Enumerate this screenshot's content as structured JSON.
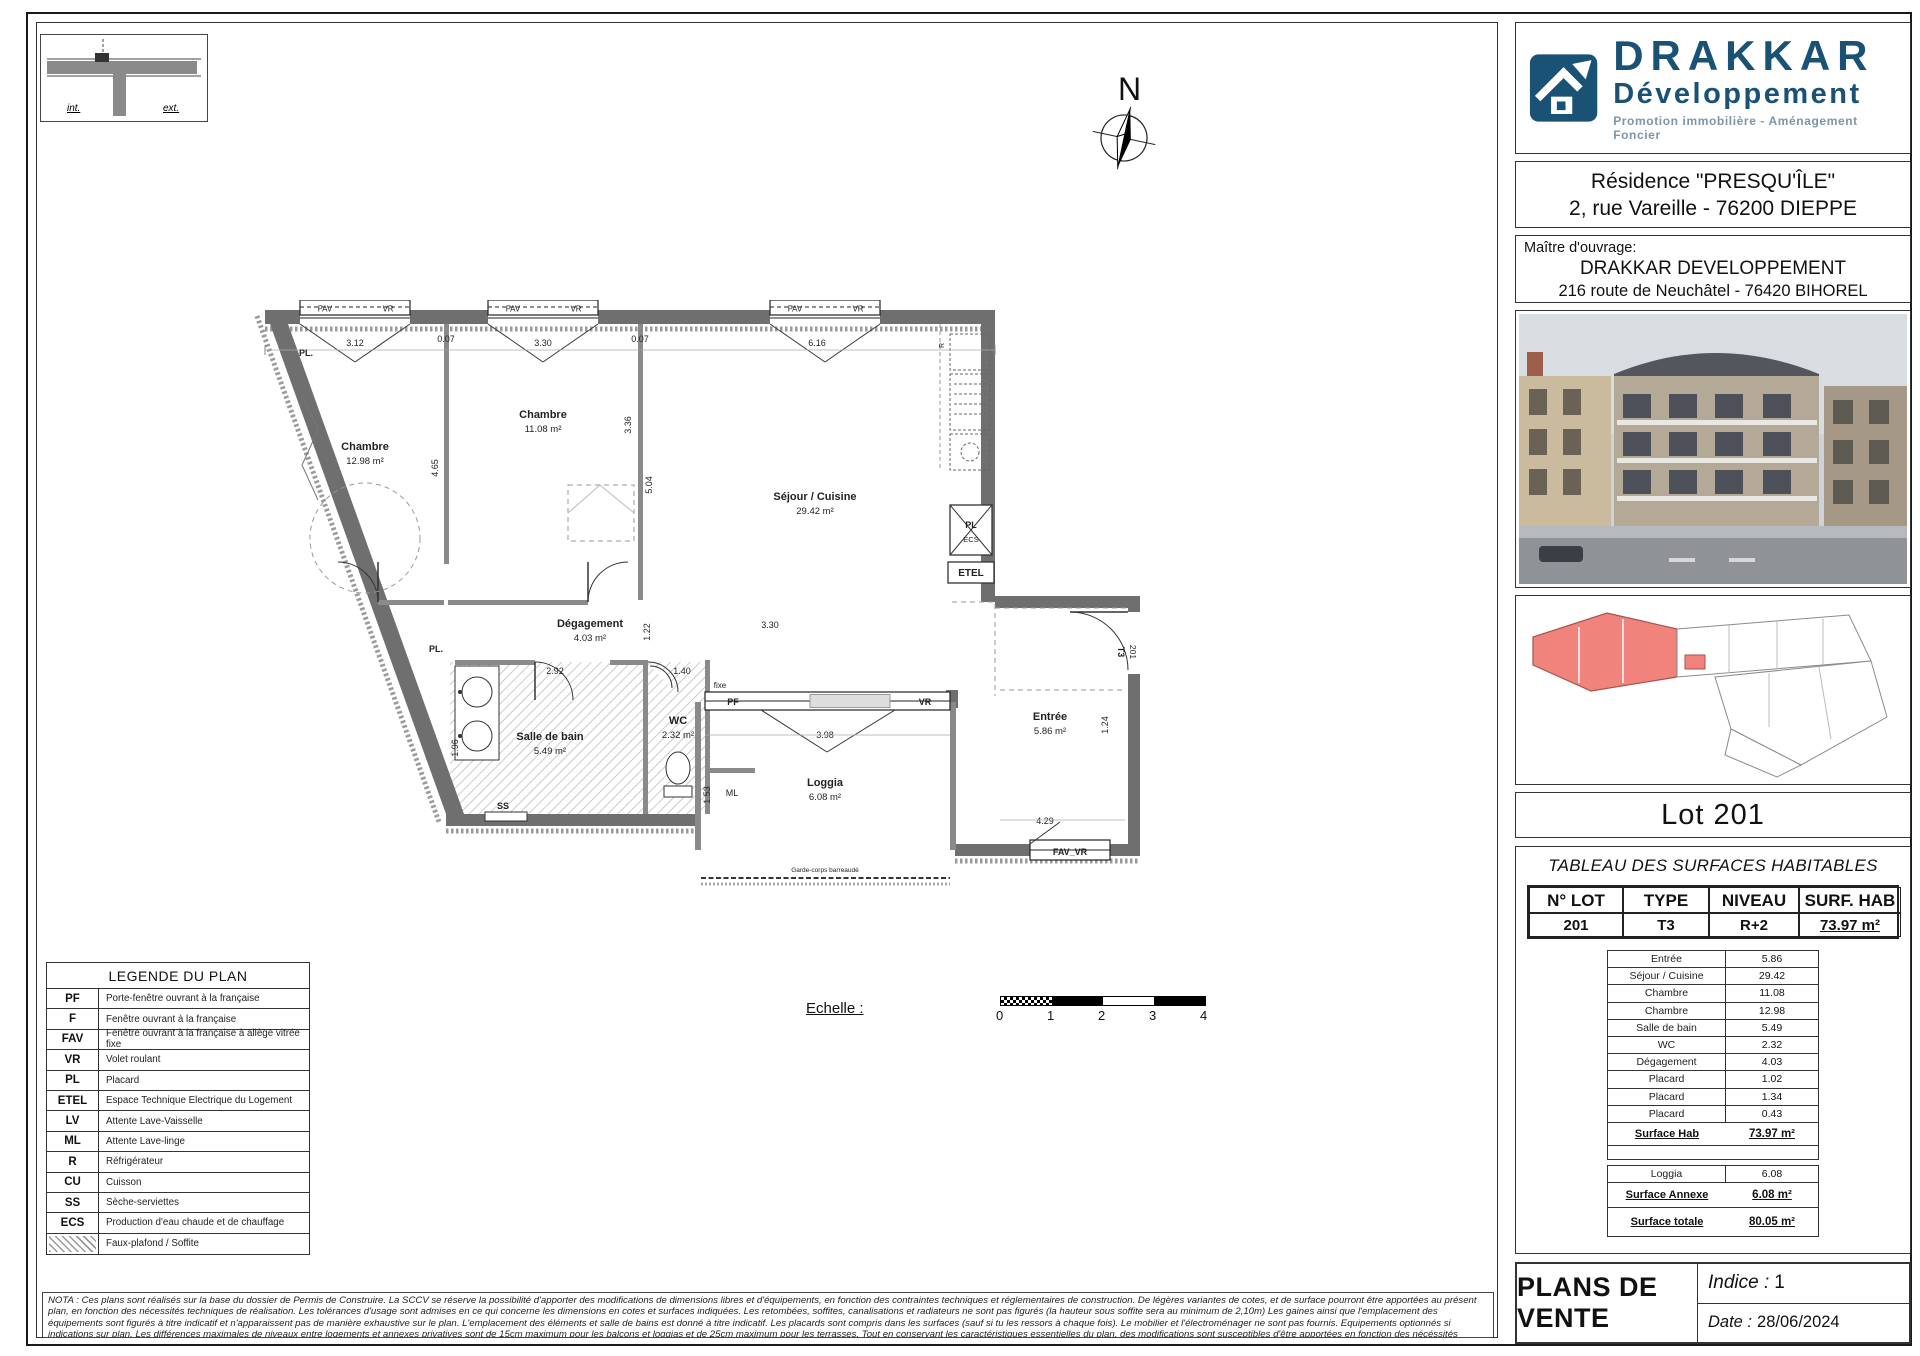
{
  "header": {
    "logo": {
      "name": "DRAKKAR",
      "subname": "Développement",
      "tagline": "Promotion immobilière - Aménagement Foncier",
      "brand_color": "#1a5276"
    },
    "residence": {
      "line1": "Résidence \"PRESQU'ÎLE\"",
      "line2": "2, rue Vareille - 76200 DIEPPE"
    },
    "maitre": {
      "label": "Maître d'ouvrage:",
      "line1": "DRAKKAR DEVELOPPEMENT",
      "line2": "216 route de Neuchâtel - 76420 BIHOREL"
    }
  },
  "lot": {
    "title": "Lot 201"
  },
  "surfaces": {
    "title": "TABLEAU DES SURFACES HABITABLES",
    "headers": [
      "N° LOT",
      "TYPE",
      "NIVEAU",
      "SURF. HAB"
    ],
    "main_row": {
      "lot": "201",
      "type": "T3",
      "niveau": "R+2",
      "surf": "73.97 m²"
    },
    "rooms": [
      {
        "label": "Entrée",
        "value": "5.86"
      },
      {
        "label": "Séjour / Cuisine",
        "value": "29.42"
      },
      {
        "label": "Chambre",
        "value": "11.08"
      },
      {
        "label": "Chambre",
        "value": "12.98"
      },
      {
        "label": "Salle de bain",
        "value": "5.49"
      },
      {
        "label": "WC",
        "value": "2.32"
      },
      {
        "label": "Dégagement",
        "value": "4.03"
      },
      {
        "label": "Placard",
        "value": "1.02"
      },
      {
        "label": "Placard",
        "value": "1.34"
      },
      {
        "label": "Placard",
        "value": "0.43"
      }
    ],
    "surface_hab": {
      "label": "Surface Hab",
      "value": "73.97 m²"
    },
    "loggia": {
      "label": "Loggia",
      "value": "6.08"
    },
    "surface_annexe": {
      "label": "Surface Annexe",
      "value": "6.08 m²"
    },
    "surface_totale": {
      "label": "Surface totale",
      "value": "80.05 m²"
    }
  },
  "legend": {
    "title": "LEGENDE DU PLAN",
    "items": [
      {
        "code": "PF",
        "label": "Porte-fenêtre ouvrant à la française"
      },
      {
        "code": "F",
        "label": "Fenêtre ouvrant à la française"
      },
      {
        "code": "FAV",
        "label": "Fenêtre ouvrant à la française à allège vitrée fixe"
      },
      {
        "code": "VR",
        "label": "Volet roulant"
      },
      {
        "code": "PL",
        "label": "Placard"
      },
      {
        "code": "ETEL",
        "label": "Espace Technique Electrique du Logement"
      },
      {
        "code": "LV",
        "label": "Attente Lave-Vaisselle"
      },
      {
        "code": "ML",
        "label": "Attente Lave-linge"
      },
      {
        "code": "R",
        "label": "Réfrigérateur"
      },
      {
        "code": "CU",
        "label": "Cuisson"
      },
      {
        "code": "SS",
        "label": "Sèche-serviettes"
      },
      {
        "code": "ECS",
        "label": "Production d'eau chaude et de chauffage"
      },
      {
        "code": "",
        "label": "Faux-plafond / Soffite",
        "swatch": "hatch-box"
      }
    ]
  },
  "nota": {
    "text": "NOTA : Ces plans sont réalisés sur la base du dossier de Permis de Construire. La SCCV se réserve la possibilité d'apporter des modifications de dimensions libres et d'équipements, en fonction des contraintes techniques et réglementaires de construction. De légères variantes de cotes, et de surface pourront être apportées au présent plan, en fonction des nécessités techniques de réalisation. Les tolérances d'usage sont admises en ce qui concerne les dimensions en cotes et surfaces indiquées. Les retombées, soffites, canalisations et radiateurs ne sont pas figurés (la hauteur sous soffite sera au minimum de 2,10m) Les gaines ainsi que l'emplacement des équipements sont figurés à titre indicatif et n'apparaissent pas de manière exhaustive sur le plan. L'emplacement des éléments et salle de bains est donné à titre indicatif. Les placards sont compris dans les surfaces (sauf si tu les ressors à chaque fois). Le mobilier et l'électroménager ne sont pas fournis. Equipements optionnés si indications sur plan. Les différences maximales de niveaux entre logements et annexes privatives sont de 15cm maximum pour les balcons et loggias et de 25cm maximum pour les terrasses. Tout en conservant les caractéristiques essentielles du plan, des modifications sont susceptibles d'être apportées en fonction des nécéssités techniques et réglementaires lors de la réalisation."
  },
  "scale": {
    "label": "Echelle :",
    "ticks": [
      "0",
      "1",
      "2",
      "3",
      "4"
    ]
  },
  "footer": {
    "title": "PLANS DE VENTE",
    "indice_label": "Indice :",
    "indice_value": "1",
    "date_label": "Date :",
    "date_value": "28/06/2024"
  },
  "compass": {
    "n": "N"
  },
  "detail_box": {
    "int": "int.",
    "ext": "ext."
  },
  "plan": {
    "rooms": [
      {
        "name": "Chambre",
        "area": "12.98 m²"
      },
      {
        "name": "Chambre",
        "area": "11.08 m²"
      },
      {
        "name": "Séjour / Cuisine",
        "area": "29.42 m²"
      },
      {
        "name": "Dégagement",
        "area": "4.03 m²"
      },
      {
        "name": "Salle de bain",
        "area": "5.49 m²"
      },
      {
        "name": "WC",
        "area": "2.32 m²"
      },
      {
        "name": "Loggia",
        "area": "6.08 m²"
      },
      {
        "name": "Entrée",
        "area": "5.86 m²"
      }
    ],
    "labels": {
      "fav": "FAV",
      "vr": "VR",
      "pf": "PF",
      "fixe": "fixe",
      "pl": "PL.",
      "pl2": "PL",
      "ecs": "ECS",
      "etel": "ETEL",
      "r": "R",
      "ss": "SS",
      "ml": "ML",
      "fav_vr": "FAV_VR",
      "t3": "T3",
      "lot": "201",
      "garde": "Garde-corps barreaudé"
    },
    "dims": {
      "d312": "3.12",
      "d007": "0.07",
      "d330": "3.30",
      "d616": "6.16",
      "d465": "4.65",
      "d336": "3.36",
      "d504": "5.04",
      "d122": "1.22",
      "d330b": "3.30",
      "d292": "2.92",
      "d140": "1.40",
      "d196": "1.96",
      "d153": "1.53",
      "d398": "3.98",
      "d429": "4.29",
      "d124": "1.24"
    }
  },
  "colors": {
    "brand": "#1a5276",
    "wall": "#6f6f6f",
    "unit_highlight": "#f0837c"
  }
}
